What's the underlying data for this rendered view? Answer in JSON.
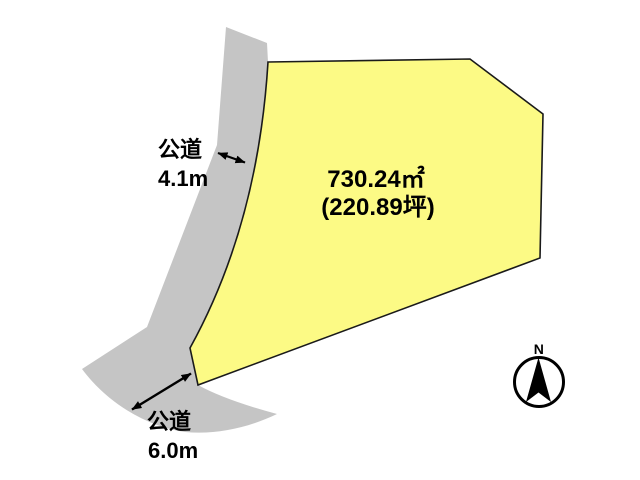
{
  "diagram": {
    "title": "land-plot-layout",
    "plot": {
      "area_m2": "730.24㎡",
      "area_tsubo": "(220.89坪)"
    },
    "roads": [
      {
        "name": "公道",
        "width": "4.1m"
      },
      {
        "name": "公道",
        "width": "6.0m"
      }
    ],
    "compass": {
      "label": "N",
      "icon": "north-arrow-icon"
    },
    "colors": {
      "plot_fill": "#FCFA85",
      "plot_stroke": "#1a1a1a",
      "road_fill": "#C5C5C5",
      "arrow": "#000000",
      "text": "#000000",
      "background": "#ffffff"
    }
  }
}
